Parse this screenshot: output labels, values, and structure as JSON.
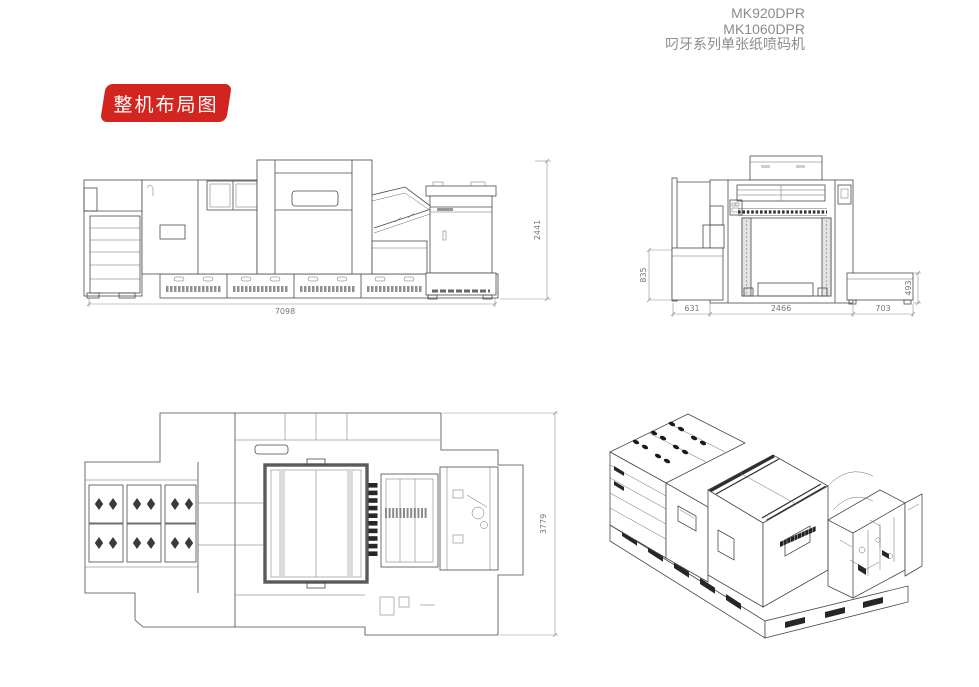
{
  "header": {
    "models": [
      "MK920DPR",
      "MK1060DPR"
    ],
    "subtitle": "叼牙系列单张纸喷码机",
    "text_color": "#8c8c8c"
  },
  "badge": {
    "label": "整机布局图",
    "background_color": "#d3251f",
    "text_color": "#ffffff"
  },
  "drawings": {
    "side_view": {
      "overall_width": "7098",
      "overall_height": "2441"
    },
    "front_view": {
      "left_platform_width": "631",
      "body_width": "2466",
      "right_platform_width": "703",
      "left_platform_height": "835",
      "right_platform_height": "493"
    },
    "plan_view": {
      "overall_depth": "3779"
    }
  },
  "line_color": "#4a4a4a"
}
